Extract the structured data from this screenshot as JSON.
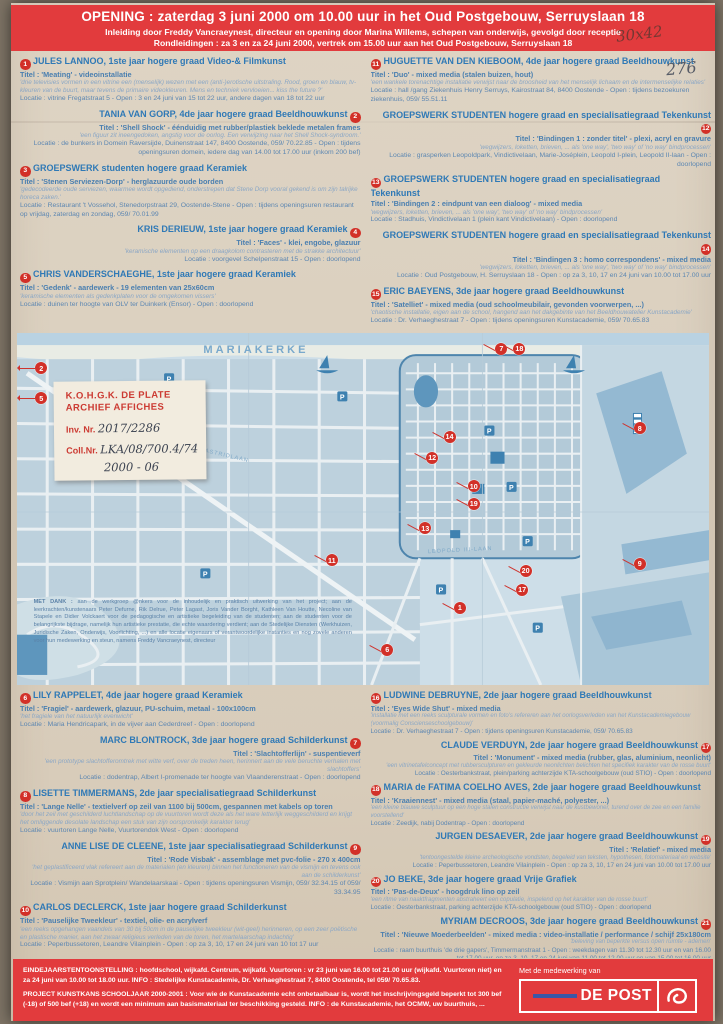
{
  "colors": {
    "band_red": "#e23b3d",
    "badge_red": "#d23028",
    "heading_blue": "#2f79b6",
    "body_blue": "#5d87b2",
    "map_blue": "#cddee8",
    "note_red": "#cc3b33",
    "depost_blue": "#3a57a7"
  },
  "meta_notes": {
    "size_note": "30x42",
    "archive_number": "276"
  },
  "header": {
    "line1": "OPENING : zaterdag 3 juni 2000 om 10.00 uur in het Oud Postgebouw, Serruyslaan 18",
    "line2": "Inleiding door Freddy Vancraeynest, directeur en opening door Marina Willems, schepen van onderwijs, gevolgd door receptie",
    "line3": "Rondleidingen : za 3 en za 24 juni 2000, vertrek om 15.00 uur aan het Oud Postgebouw, Serruyslaan 18"
  },
  "entries_top_left": [
    {
      "num": "1",
      "align": "left",
      "name": "JULES LANNOO, 1ste jaar hogere graad Video-& Filmkunst",
      "title": "Titel : 'Meating' - videoinstallatie",
      "desc": "'drie televisies vormen in een vitrine een (menselijk) wezen met een (anti-)erotische uitstraling. Rood, groen en blauw, tv-kleuren van de buurt, maar tevens de primaire videokleuren. Mens en techniek vervloeien... kiss the future ?'",
      "loc": "Locatie : vitrine Fregatstraat 5 - Open : 3 en 24 juni van 15 tot 22 uur, andere dagen van 18 tot 22 uur"
    },
    {
      "num": "2",
      "align": "right",
      "name": "TANIA VAN GORP, 4de jaar hogere graad Beeldhouwkunst",
      "title": "Titel : 'Shell Shock' - éénduidig met rubber/plastiek beklede metalen frames",
      "desc": "'een figuur zit ineengedoken, angstig voor de oorlog. Een verwijzing naar het Shell Shock-syndroom.'",
      "loc": "Locatie : de bunkers in Domein Raversijde, Duinenstraat 147, 8400 Oostende, 059/ 70.22.85 - Open : tijdens openingsuren domein, iedere dag van 14.00 tot 17.00 uur (inkom 200 bef)"
    },
    {
      "num": "3",
      "align": "left",
      "name": "GROEPSWERK studenten hogere graad Keramiek",
      "title": "Titel : 'Stenen Serviezen-Dorp' - herglazuurde oude borden",
      "desc": "'gedecodeerde oude serviezen, waarmee wordt opgediend, onderstrepen dat Stene Dorp vooral gekend is om zijn talrijke horeca zaken.'",
      "loc": "Locatie : Restaurant 't Vossehol, Stenedorpstraat 29, Oostende-Stene - Open : tijdens openingsuren restaurant op vrijdag, zaterdag en zondag, 059/ 70.01.99"
    },
    {
      "num": "4",
      "align": "right",
      "name": "KRIS DERIEUW, 1ste jaar hogere graad Keramiek",
      "title": "Titel : 'Faces' - klei, engobe, glazuur",
      "desc": "'keramische elementen op een draagkolom contrasteren met de strakke architectuur'",
      "loc": "Locatie : voorgevel Schelpenstraat 15 - Open : doorlopend"
    },
    {
      "num": "5",
      "align": "left",
      "name": "CHRIS VANDERSCHAEGHE, 1ste jaar hogere graad Keramiek",
      "title": "Titel : 'Gedenk' - aardewerk - 19 elementen van 25x60cm",
      "desc": "'keramische elementen als gedenkplaten voor de omgekomen vissers'",
      "loc": "Locatie : duinen ter hoogte van OLV ter Duinkerk (Ensor) - Open : doorlopend"
    }
  ],
  "entries_top_right": [
    {
      "num": "11",
      "align": "left",
      "name": "HUGUETTE VAN DEN KIEBOOM, 4de jaar hogere graad Beeldhouwkunst",
      "title": "Titel : 'Duo' - mixed media (stalen buizen, hout)",
      "desc": "'een wankele torenachtige installatie verwijst naar de broosheid van het menselijk lichaam en de intermenselijke relaties'",
      "loc": "Locatie : hall /gang Ziekenhuis Henry Serruys, Kairostraat 84, 8400 Oostende - Open : tijdens bezoekuren ziekenhuis, 059/ 55.51.11"
    },
    {
      "num": "12",
      "align": "right",
      "name": "GROEPSWERK STUDENTEN hogere graad en specialisatiegraad Tekenkunst",
      "title": "Titel : 'Bindingen 1 : zonder titel' - plexi, acryl en gravure",
      "desc": "'wegwijzers, loketten, brieven, ... als 'one way', 'two way' of 'no way' bindprocessen'",
      "loc": "Locatie : grasperken Leopoldpark, Vindictivelaan, Marie-Joséplein, Leopold I-plein, Leopold II-laan - Open : doorlopend"
    },
    {
      "num": "13",
      "align": "left",
      "name": "GROEPSWERK STUDENTEN hogere graad en specialisatiegraad Tekenkunst",
      "title": "Titel : 'Bindingen 2 : eindpunt van een dialoog' - mixed media",
      "desc": "'wegwijzers, loketten, brieven, ... als 'one way', 'two way' of 'no way' bindprocessen'",
      "loc": "Locatie : Stadhuis, Vindictivelaan 1 (plein kant Vindictivelaan) - Open : doorlopend"
    },
    {
      "num": "14",
      "align": "right",
      "name": "GROEPSWERK STUDENTEN hogere graad en specialisatiegraad Tekenkunst",
      "title": "Titel : 'Bindingen 3 : homo correspondens' - mixed media",
      "desc": "'wegwijzers, loketten, brieven, ... als 'one way', 'two way' of 'no way' bindprocessen'",
      "loc": "Locatie : Oud Postgebouw, H. Serruyslaan 18 - Open : op za 3, 10, 17 en 24 juni van 10.00 tot 17.00 uur"
    },
    {
      "num": "15",
      "align": "left",
      "name": "ERIC BAEYENS, 3de jaar hogere graad Beeldhouwkunst",
      "title": "Titel : 'Satelliet' - mixed media (oud schoolmeubilair, gevonden voorwerpen, ...)",
      "desc": "'chaotische installatie, eigen aan de school, hangend aan het dakgebinte van het Beeldhouwatelier Kunstacademie'",
      "loc": "Locatie : Dr. Verhaeghestraat 7 - Open : tijdens openingsuren Kunstacademie, 059/ 70.65.83"
    }
  ],
  "entries_bottom_left": [
    {
      "num": "6",
      "align": "left",
      "name": "LILY RAPPELET, 4de jaar hogere graad Keramiek",
      "title": "Titel : 'Fragiel' - aardewerk, glazuur, PU-schuim, metaal - 100x100cm",
      "desc": "'het fragiele van het natuurlijk evenwicht'",
      "loc": "Locatie : Maria Hendricapark, in de vijver aan Cederdreef - Open : doorlopend"
    },
    {
      "num": "7",
      "align": "right",
      "name": "MARC BLONTROCK, 3de jaar hogere graad Schilderkunst",
      "title": "Titel : 'Slachtofferlijn' - suspentieverf",
      "desc": "'een prototype slachtofferomtrek met witte verf, over de treden heen, herinnert aan de vele beruchte verhalen met slachtoffers'",
      "loc": "Locatie : dodentrap, Albert I-promenade ter hoogte van Vlaanderenstraat - Open : doorlopend"
    },
    {
      "num": "8",
      "align": "left",
      "name": "LISETTE TIMMERMANS, 2de jaar specialisatiegraad Schilderkunst",
      "title": "Titel : 'Lange Nelle' - textielverf op zeil van 1100 bij 500cm, gespannen met kabels op toren",
      "desc": "'door het zeil met geschilderd luchtlandschap op de vuurtoren wordt deze als het ware letterlijk weggeschilderd en krijgt het omliggende desolate landschap een stuk van zijn oorspronkelijk karakter terug'",
      "loc": "Locatie : vuurtoren Lange Nelle, Vuurtorendok West - Open : doorlopend"
    },
    {
      "num": "9",
      "align": "right",
      "name": "ANNE LISE DE CLEENE, 1ste jaar specialisatiegraad Schilderkunst",
      "title": "Titel : 'Rode Visbak' - assemblage met pvc-folie - 270 x 400cm",
      "desc": "'het geplastificeerd vlak refereert aan de materialen (en kleuren) binnen het functioneren van de vismijn en tevens ook aan de schilderkunst'",
      "loc": "Locatie : Vismijn aan Sprotplein/ Wandelaarskaai - Open : tijdens openingsuren Vismijn, 059/ 32.34.15 of 059/ 33.34.95"
    },
    {
      "num": "10",
      "align": "left",
      "name": "CARLOS DECLERCK, 1ste jaar hogere graad Schilderkunst",
      "title": "Titel : 'Pauselijke Tweekleur' - textiel, olie- en acrylverf",
      "desc": "'een reeks opgehangen vaandels van 30 bij 50cm in de pauselijke tweekleur (wit-geel) herinneren, op een zeer poëtische en plastische manier, aan het zwaar religieus verleden van de toren, het martelaarschap indachtig'",
      "loc": "Locatie : Peperbussetoren, Leandre Vilainplein - Open : op za 3, 10, 17 en 24 juni van 10 tot 17 uur"
    }
  ],
  "entries_bottom_right": [
    {
      "num": "16",
      "align": "left",
      "name": "LUDWINE DEBRUYNE, 2de jaar hogere graad Beeldhouwkunst",
      "title": "Titel : 'Eyes Wide Shut' - mixed media",
      "desc": "'installatie met een reeks sculpturale vormen en foto's refereren aan het oorlogsverleden van het Kunstacademiegebouw (voormalig Conscienseschoolgebouw)'",
      "loc": "Locatie : Dr. Verhaeghestraat 7 - Open : tijdens openingsuren Kunstacademie, 059/ 70.65.83"
    },
    {
      "num": "17",
      "align": "right",
      "name": "CLAUDE VERDUYN, 2de jaar hogere graad Beeldhouwkunst",
      "title": "Titel : 'Monument' - mixed media (rubber, glas, aluminium, neonlicht)",
      "desc": "'een vitrinetafelconcept met rubbersculpturen en gekleurde neonlichten belichten het specifiek karakter van de rosse buurt'",
      "loc": "Locatie : Oesterbankstraat, plein/parking achterzijde KTA-schoolgebouw (oud STIO) - Open : doorlopend"
    },
    {
      "num": "18",
      "align": "left",
      "name": "MARIA de FATIMA COELHO AVES, 2de jaar hogere graad Beeldhouwkunst",
      "title": "Titel : 'Kraaiennest' - mixed media (staal, papier-maché, polyester, ...)",
      "desc": "'een kleine blauwe sculptuur op een hoge stalen constructie verwijst naar de kustbewoner, turend over de zee en een familie voorstellend'",
      "loc": "Locatie : Zeedijk, nabij Dodentrap - Open : doorlopend"
    },
    {
      "num": "19",
      "align": "right",
      "name": "JURGEN DESAEVER, 2de jaar hogere graad Beeldhouwkunst",
      "title": "Titel : 'Relatief' - mixed media",
      "desc": "'tentoongestelde kleine archeologische vondsten, begeleid van teksten, hypothesen, fotomateriaal en website'",
      "loc": "Locatie : Peperbussetoren, Leandre Vilainplein - Open : op za 3, 10, 17 en 24 juni van 10.00 tot 17.00 uur"
    },
    {
      "num": "20",
      "align": "left",
      "name": "JO BEKE, 3de jaar hogere graad Vrije Grafiek",
      "title": "Titel : 'Pas-de-Deux' - hoogdruk lino op zeil",
      "desc": "'een ritme van naaktfragmenten abstraheert een copulatie, inspelend op het karakter van de rosse buurt'",
      "loc": "Locatie : Oesterbankstraat, parking achterzijde KTA-schoolgebouw (oud STIO) - Open : doorlopend"
    },
    {
      "num": "21",
      "align": "right",
      "name": "MYRIAM DECROOS, 3de jaar hogere graad Beeldhouwkunst",
      "title": "Titel : 'Nieuwe Moederbeelden' - mixed media : video-installatie / performance / schijf 25x180cm",
      "desc": "'beleving van beperkte versus open ruimte - ademen'",
      "loc": "Locatie : raam buurthuis 'de drie gapers', Timmermanstraat 1 - Open : weekdagen van 11.30 tot 12.30 uur en van 16.00 tot 17.00 uur, op za 3, 10, 17 en 24 juni van 11.00 tot 12.00 uur en van 15.00 tot 16.00 uur"
    }
  ],
  "map": {
    "area_label": "MARIAKERKE",
    "street_label_1": "KONINGIN ASTRIDLAAN",
    "street_label_2": "LEOPOLD III-LAAN",
    "parking_label": "P",
    "thanks_bold": "MET DANK :",
    "thanks_text": " aan de werkgroep @nkers voor de inhoudelijk en praktisch uitwerking van het project; aan de leerkrachten/kunstenaars Peter Defurne, Rik Delrue, Peter Lagast, Joris Vander Borght, Kathleen Van Houtte, Necoline van Stapele en Didier Volckaert voor de pedagogische en artistieke begeleiding van de studenten; aan de studenten voor de belangrijkste bijdrage, namelijk hun artistieke prestatie, die echte waardering verdient; aan de Stedelijke Diensten (Werkhuizen, Juridische Zaken, Onderwijs, Voorlichting, ...) en alle locatie eigenaars of verantwoordelijke instanties en nog zovele anderen voor hun medewerking en steun, namens Freddy Vancraeynest, directeur",
    "markers": [
      {
        "n": "2",
        "x": 3.5,
        "y": 10,
        "arrow": true
      },
      {
        "n": "5",
        "x": 3.5,
        "y": 18.5,
        "arrow": true
      },
      {
        "n": "7",
        "x": 70,
        "y": 4.5
      },
      {
        "n": "18",
        "x": 72.6,
        "y": 4.5
      },
      {
        "n": "8",
        "x": 90,
        "y": 27
      },
      {
        "n": "14",
        "x": 62.5,
        "y": 29.5
      },
      {
        "n": "12",
        "x": 60,
        "y": 35.5
      },
      {
        "n": "10",
        "x": 66,
        "y": 43.5
      },
      {
        "n": "19",
        "x": 66,
        "y": 48.5
      },
      {
        "n": "13",
        "x": 59,
        "y": 55.5
      },
      {
        "n": "11",
        "x": 45.5,
        "y": 64.5
      },
      {
        "n": "9",
        "x": 90,
        "y": 65.5
      },
      {
        "n": "20",
        "x": 73.5,
        "y": 67.5
      },
      {
        "n": "17",
        "x": 73,
        "y": 73
      },
      {
        "n": "1",
        "x": 64,
        "y": 78
      },
      {
        "n": "6",
        "x": 53.5,
        "y": 90
      }
    ]
  },
  "archive_note": {
    "line1": "K.O.H.G.K. DE PLATE",
    "line2": "ARCHIEF AFFICHES",
    "inv_label": "Inv. Nr.",
    "inv_value": "2017/2286",
    "coll_label": "Coll.Nr.",
    "coll_value": "LKA/08/700.4/74",
    "year_value": "2000 - 06"
  },
  "footer": {
    "line1": "EINDEJAARSTENTOONSTELLING : hoofdschool, wijkafd. Centrum, wijkafd. Vuurtoren : vr 23 juni van 16.00 tot 21.00 uur (wijkafd. Vuurtoren niet) en za 24 juni van 10.00 tot 18.00 uur. INFO : Stedelijke Kunstacademie, Dr. Verhaeghestraat 7, 8400 Oostende, tel 059/ 70.65.83.",
    "line2": "PROJECT KUNSTKANS SCHOOLJAAR 2000-2001 : Voor wie de Kunstacademie echt onbetaalbaar is, wordt het inschrijvingsgeld beperkt tot 300 bef (-18) of 500 bef (+18) en wordt een minimum aan basismateriaal ter beschikking gesteld. INFO : de Kunstacademie, het OCMW, uw buurthuis, ...",
    "sponsor_label": "Met de medewerking van",
    "sponsor_name": "DE POST"
  }
}
